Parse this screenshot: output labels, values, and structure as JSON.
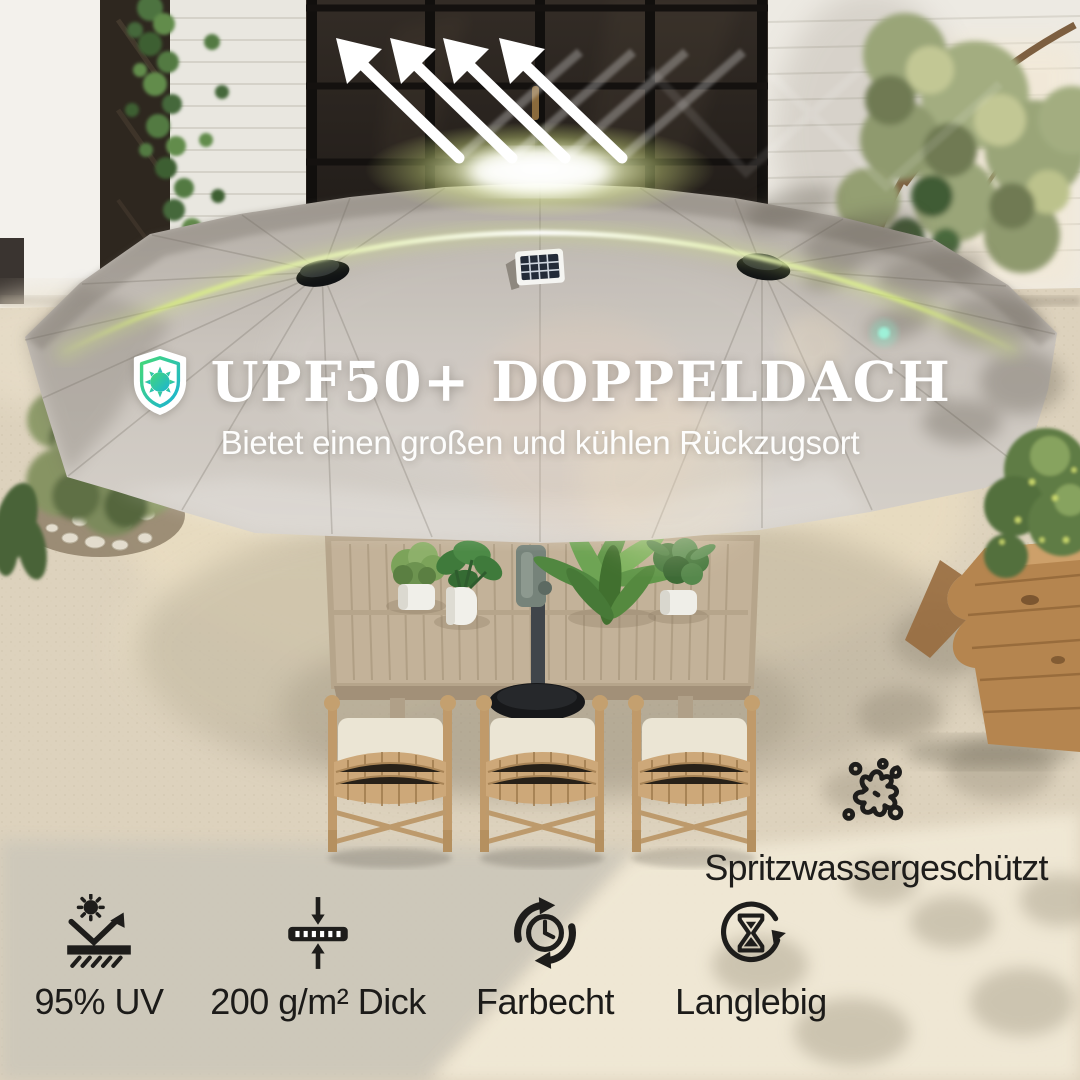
{
  "hero": {
    "badge_icon": "shield-sun-icon",
    "title": "UPF50+ DOPPELDACH",
    "subtitle": "Bietet einen großen und kühlen Rückzugsort"
  },
  "splash": {
    "icon": "water-splash-icon",
    "label": "Spritzwassergeschützt"
  },
  "features": [
    {
      "icon": "uv-reflection-icon",
      "label": "95% UV"
    },
    {
      "icon": "fabric-thickness-icon",
      "label": "200 g/m² Dick"
    },
    {
      "icon": "colorfast-clock-icon",
      "label": "Farbecht"
    },
    {
      "icon": "durable-hourglass-icon",
      "label": "Langlebig"
    }
  ],
  "colors": {
    "headline_text": "#ffffff",
    "feature_text": "#1c1b19",
    "shield_gradient_start": "#45d878",
    "shield_gradient_end": "#1ab3d4",
    "glow_arc": "#ddf27a",
    "umbrella_canopy": "#c6c0b9"
  }
}
